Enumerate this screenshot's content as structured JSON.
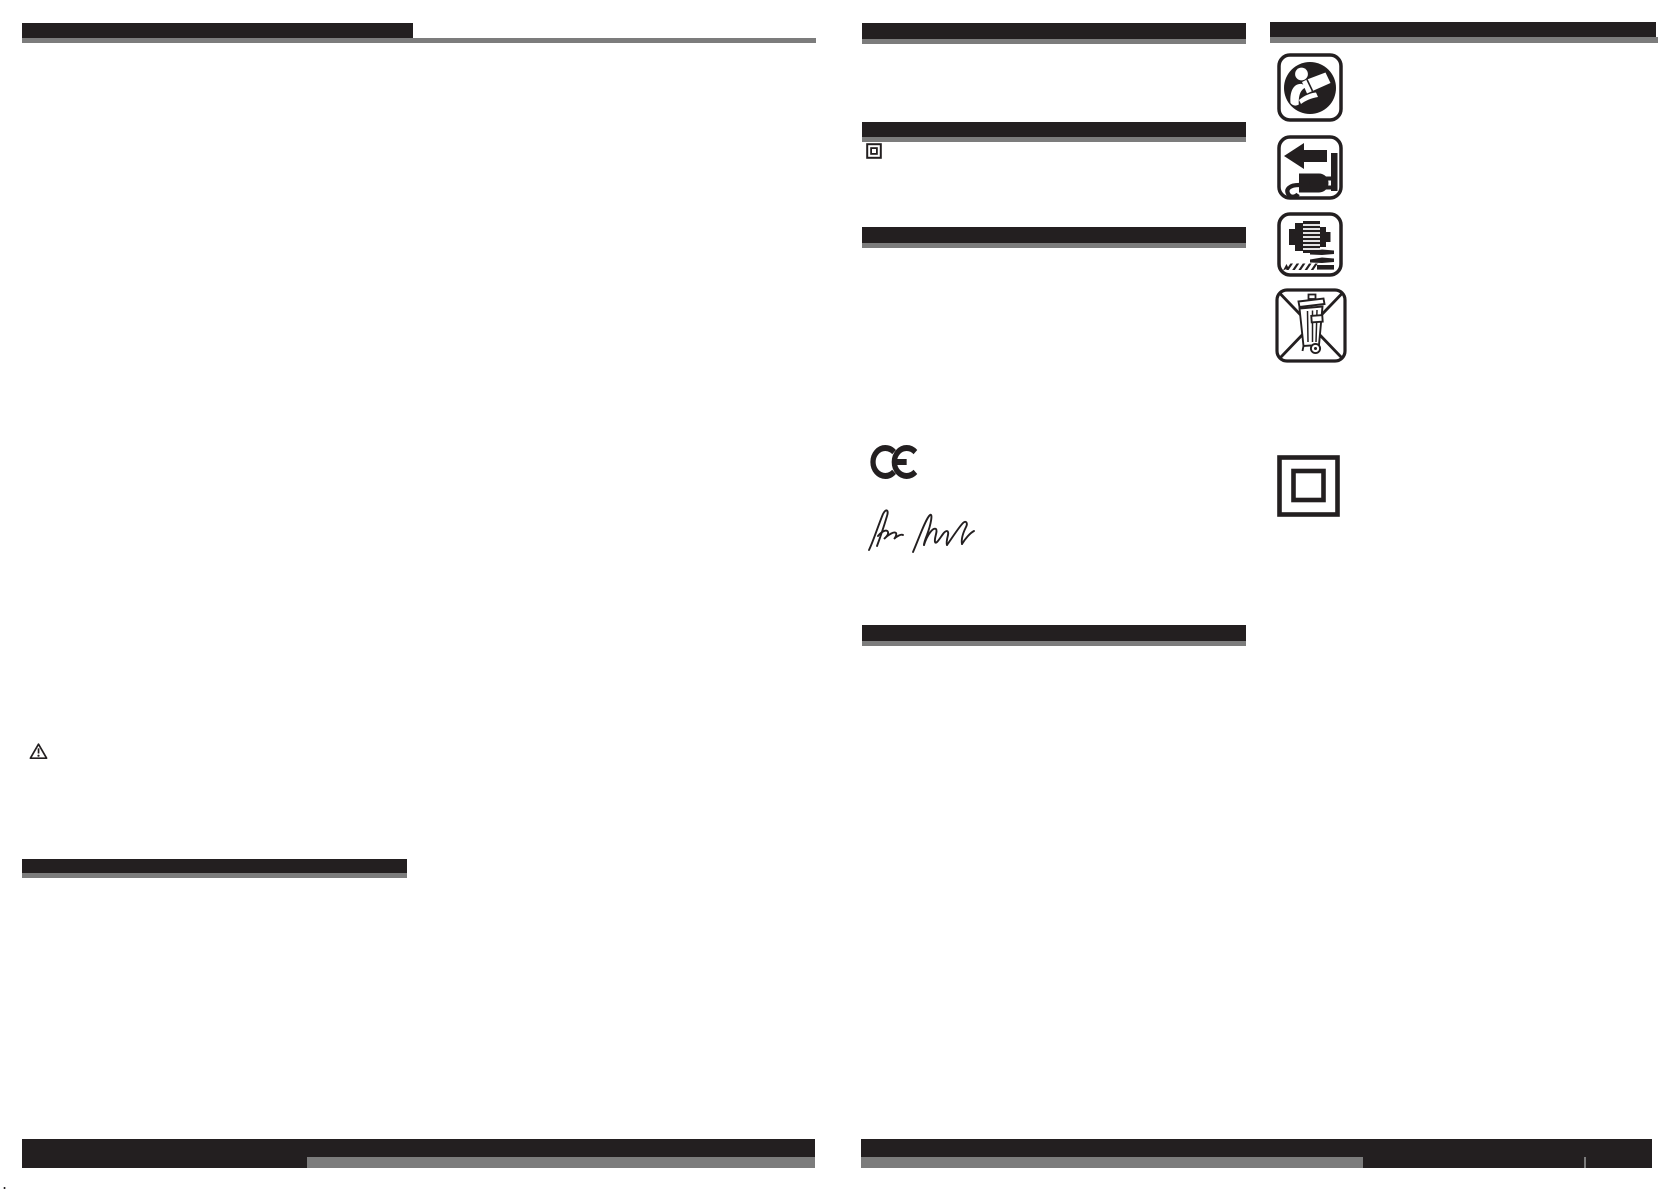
{
  "document": {
    "kind": "scanned instruction manual spread, two pages, text not printed",
    "background": "#ffffff"
  },
  "colors": {
    "ink": "#231f20",
    "rule_gray": "#7c7c7c"
  },
  "left_page": {
    "footer_dot": "."
  },
  "symbols": {
    "warning_triangle": "general warning triangle",
    "read_manual": "read the instruction manual",
    "unplug": "disconnect mains plug from socket",
    "drill_bits": "drill chuck and drill bits",
    "weee_bin": "do not dispose of with household waste (crossed-out wheelie bin)",
    "class2_small": "class II double insulation",
    "class2_large": "class II double insulation",
    "ce_mark": "CE",
    "signature": "handwritten signature"
  }
}
